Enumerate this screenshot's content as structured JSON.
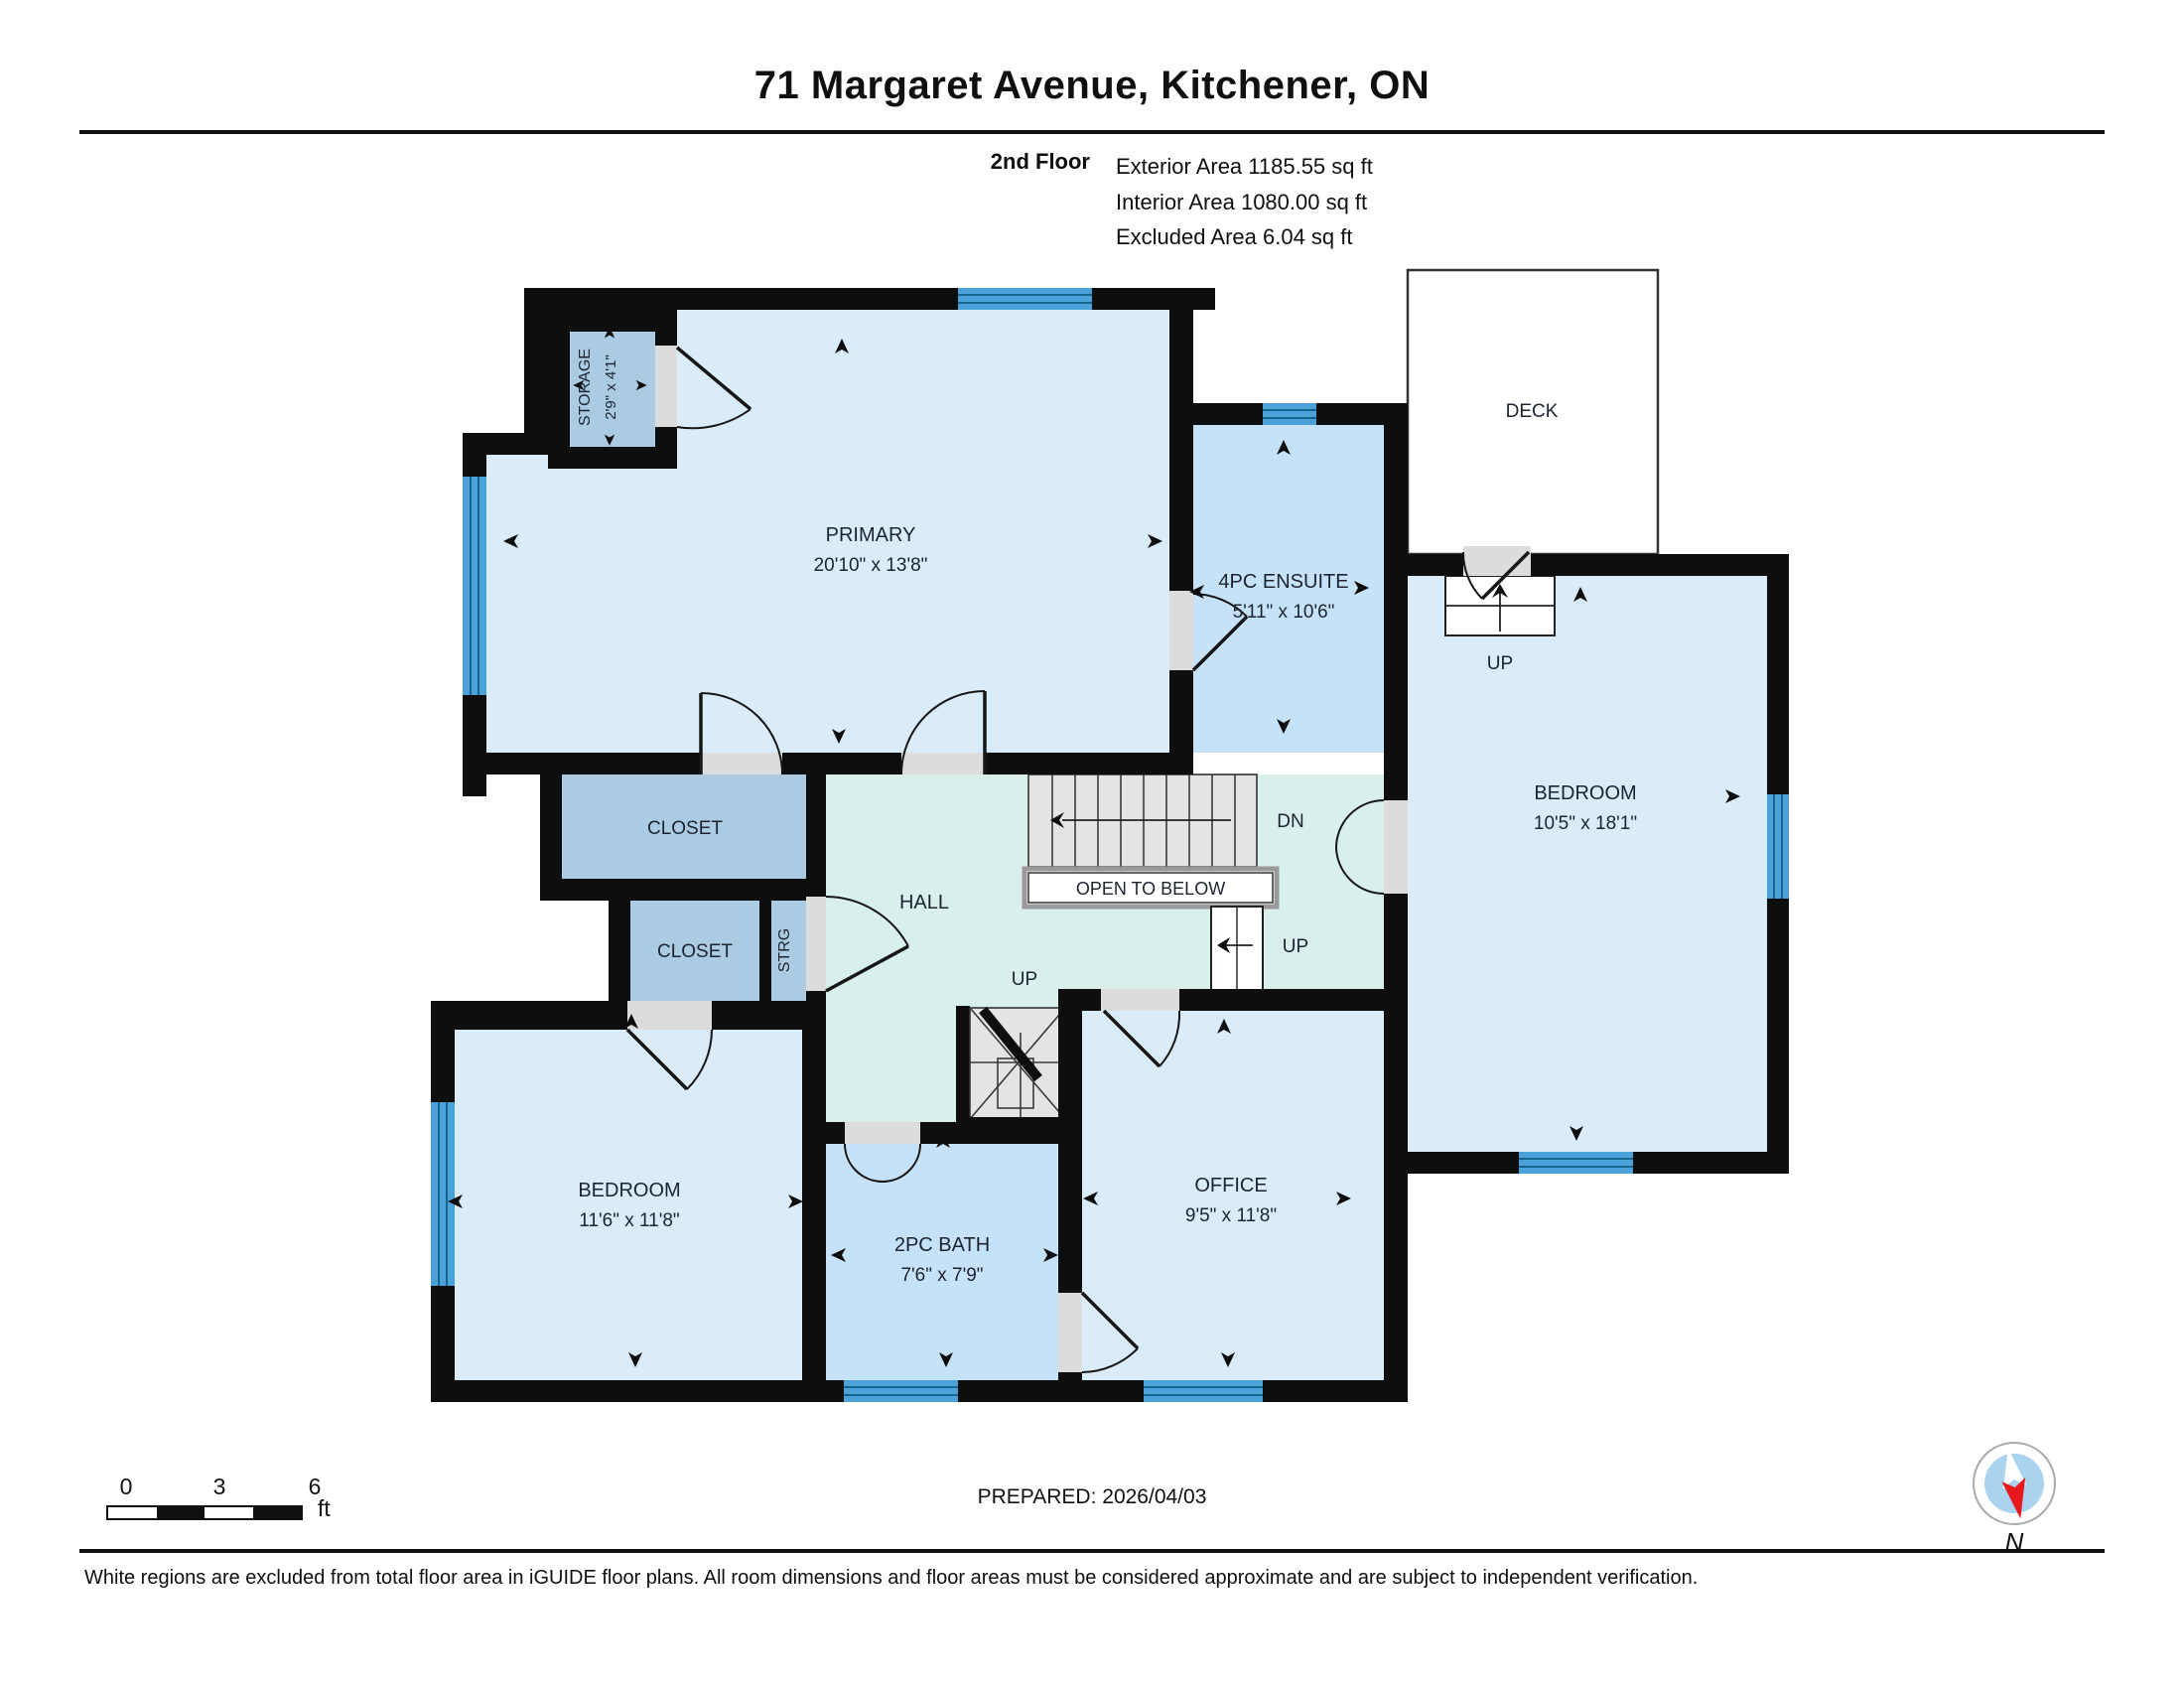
{
  "header": {
    "title": "71 Margaret Avenue, Kitchener, ON",
    "floor_label": "2nd Floor",
    "area_lines": [
      "Exterior Area 1185.55 sq ft",
      "Interior Area 1080.00 sq ft",
      "Excluded Area 6.04 sq ft"
    ]
  },
  "rooms": {
    "primary": {
      "name": "PRIMARY",
      "dims": "20'10\" x 13'8\""
    },
    "storage": {
      "name": "STORAGE",
      "dims": "2'9\" x 4'1\""
    },
    "ensuite": {
      "name": "4PC ENSUITE",
      "dims": "5'11\" x 10'6\""
    },
    "bedroom_right": {
      "name": "BEDROOM",
      "dims": "10'5\" x 18'1\""
    },
    "bedroom_left": {
      "name": "BEDROOM",
      "dims": "11'6\" x 11'8\""
    },
    "bath": {
      "name": "2PC BATH",
      "dims": "7'6\" x 7'9\""
    },
    "office": {
      "name": "OFFICE",
      "dims": "9'5\" x 11'8\""
    },
    "closet_top": {
      "name": "CLOSET"
    },
    "closet_bottom": {
      "name": "CLOSET"
    },
    "strg": {
      "name": "STRG"
    },
    "deck": {
      "name": "DECK"
    },
    "hall": {
      "name": "HALL"
    }
  },
  "labels": {
    "dn": "DN",
    "up": "UP",
    "open_to_below": "OPEN TO BELOW"
  },
  "footer": {
    "prepared": "PREPARED: 2026/04/03",
    "scale_ticks": [
      "0",
      "3",
      "6"
    ],
    "scale_unit": "ft",
    "compass_label": "N",
    "disclaimer": "White regions are excluded from total floor area in iGUIDE floor plans. All room dimensions and floor areas must be considered approximate and are subject to independent verification."
  },
  "colors": {
    "wall": "#0e0e0e",
    "room": "#daecfa",
    "wet_room": "#c6e2f8",
    "closet": "#abcbe3",
    "hall": "#d9efec",
    "window": "#4aa2d9",
    "window_line": "#19648f",
    "door_gap": "#dcdcdc",
    "stair": "#e4e4e4",
    "compass_blue": "#a9d3ee",
    "compass_red": "#e8191c",
    "text": "#1c2430"
  }
}
